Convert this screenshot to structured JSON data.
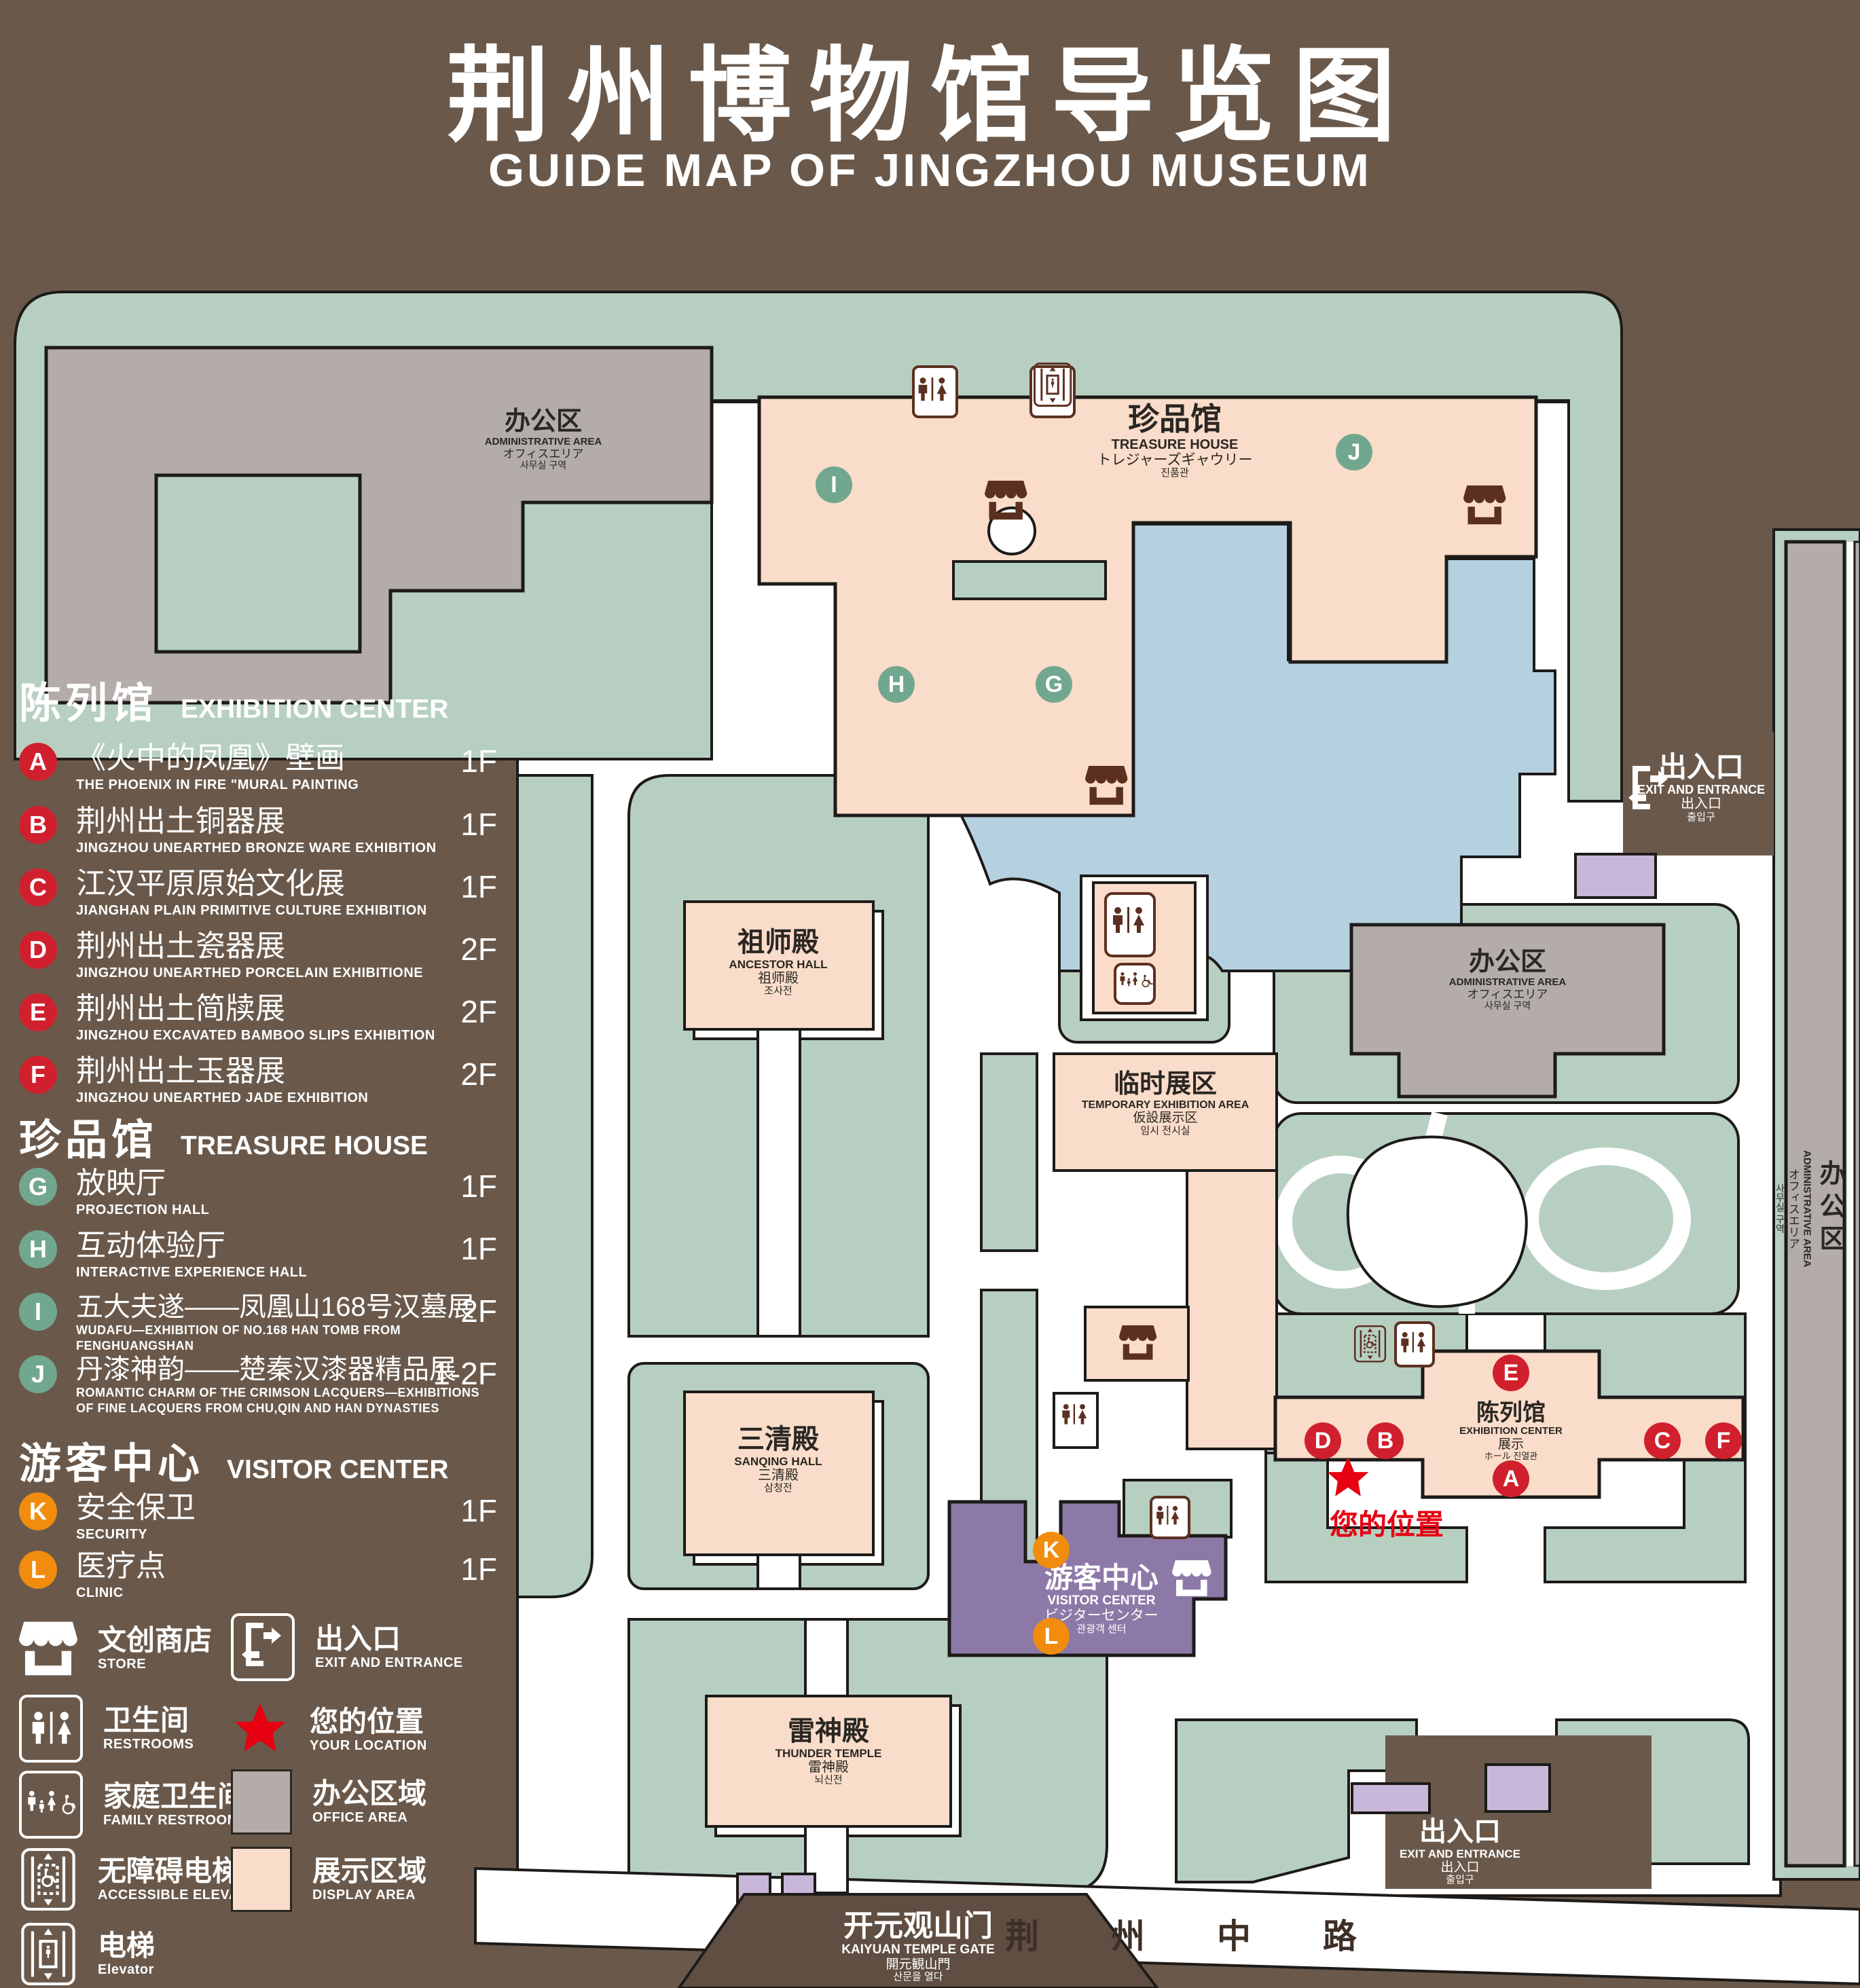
{
  "title": {
    "cn": "荆州博物馆导览图",
    "en": "GUIDE MAP OF JINGZHOU MUSEUM"
  },
  "legend": {
    "sections": [
      {
        "cn": "陈列馆",
        "en": "EXHIBITION CENTER",
        "items": [
          {
            "letter": "A",
            "cn": "《火中的凤凰》壁画",
            "en": "THE PHOENIX IN FIRE \"MURAL PAINTING",
            "floor": "1F"
          },
          {
            "letter": "B",
            "cn": "荆州出土铜器展",
            "en": "JINGZHOU UNEARTHED BRONZE WARE EXHIBITION",
            "floor": "1F"
          },
          {
            "letter": "C",
            "cn": "江汉平原原始文化展",
            "en": "JIANGHAN PLAIN PRIMITIVE CULTURE EXHIBITION",
            "floor": "1F"
          },
          {
            "letter": "D",
            "cn": "荆州出土瓷器展",
            "en": "JINGZHOU UNEARTHED PORCELAIN EXHIBITIONE",
            "floor": "2F"
          },
          {
            "letter": "E",
            "cn": "荆州出土简牍展",
            "en": "JINGZHOU EXCAVATED BAMBOO SLIPS EXHIBITION",
            "floor": "2F"
          },
          {
            "letter": "F",
            "cn": "荆州出土玉器展",
            "en": "JINGZHOU UNEARTHED JADE EXHIBITION",
            "floor": "2F"
          }
        ]
      },
      {
        "cn": "珍品馆",
        "en": "TREASURE HOUSE",
        "items": [
          {
            "letter": "G",
            "cn": "放映厅",
            "en": "PROJECTION HALL",
            "floor": "1F"
          },
          {
            "letter": "H",
            "cn": "互动体验厅",
            "en": "INTERACTIVE EXPERIENCE HALL",
            "floor": "1F"
          },
          {
            "letter": "I",
            "cn": "五大夫遂——凤凰山168号汉墓展",
            "en": "WUDAFU—EXHIBITION OF NO.168 HAN TOMB FROM FENGHUANGSHAN",
            "floor": "2F"
          },
          {
            "letter": "J",
            "cn": "丹漆神韵——楚秦汉漆器精品展",
            "en": "ROMANTIC CHARM OF THE CRIMSON LACQUERS—EXHIBITIONS",
            "en2": "OF FINE LACQUERS FROM CHU,QIN AND HAN DYNASTIES",
            "floor": "1-2F"
          }
        ]
      },
      {
        "cn": "游客中心",
        "en": "VISITOR CENTER",
        "items": [
          {
            "letter": "K",
            "cn": "安全保卫",
            "en": "SECURITY",
            "floor": "1F"
          },
          {
            "letter": "L",
            "cn": "医疗点",
            "en": "CLINIC",
            "floor": "1F"
          }
        ]
      }
    ],
    "symbols": {
      "store": {
        "cn": "文创商店",
        "en": "STORE"
      },
      "exit": {
        "cn": "出入口",
        "en": "EXIT AND ENTRANCE"
      },
      "restrooms": {
        "cn": "卫生间",
        "en": "RESTROOMS"
      },
      "location": {
        "cn": "您的位置",
        "en": "YOUR LOCATION"
      },
      "family": {
        "cn": "家庭卫生间",
        "en": "FAMILY RESTROOMS"
      },
      "office": {
        "cn": "办公区域",
        "en": "OFFICE AREA"
      },
      "accessible": {
        "cn": "无障碍电梯",
        "en": "ACCESSIBLE ELEVATOR"
      },
      "display": {
        "cn": "展示区域",
        "en": "DISPLAY AREA"
      },
      "elevator": {
        "cn": "电梯",
        "en": "Elevator"
      }
    }
  },
  "map": {
    "buildings": {
      "admin_nw": {
        "cn": "办公区",
        "en": "ADMINISTRATIVE AREA",
        "ja": "オフィスエリア",
        "ko": "사무실 구역"
      },
      "treasure": {
        "cn": "珍品馆",
        "en": "TREASURE HOUSE",
        "ja": "トレジャーズギャウリー",
        "ko": "진품관"
      },
      "ancestor": {
        "cn": "祖师殿",
        "en": "ANCESTOR HALL",
        "ja": "祖师殿",
        "ko": "조사전"
      },
      "sanqing": {
        "cn": "三清殿",
        "en": "SANQING HALL",
        "ja": "三清殿",
        "ko": "삼청전"
      },
      "temporary": {
        "cn": "临时展区",
        "en": "TEMPORARY EXHIBITION AREA",
        "ja": "仮設展示区",
        "ko": "임시 전시실"
      },
      "admin_e": {
        "cn": "办公区",
        "en": "ADMINISTRATIVE AREA",
        "ja": "オフィスエリア",
        "ko": "사무실 구역"
      },
      "admin_strip": {
        "cn": "办公区",
        "en": "ADMINISTRATIVE AREA",
        "ja": "オフィスエリア",
        "ko": "사무실 구역"
      },
      "exhibition": {
        "cn": "陈列馆",
        "en": "EXHIBITION CENTER",
        "ja": "展示",
        "ko": "ホール 진열관"
      },
      "visitor": {
        "cn": "游客中心",
        "en": "VISITOR CENTER",
        "ja": "ビジターセンター",
        "ko": "관광객 센터"
      },
      "thunder": {
        "cn": "雷神殿",
        "en": "THUNDER TEMPLE",
        "ja": "雷神殿",
        "ko": "뇌신전"
      },
      "gate": {
        "cn": "开元观山门",
        "en": "KAIYUAN TEMPLE GATE",
        "ja": "開元観山門",
        "ko": "산문을 열다"
      },
      "exit_e": {
        "cn": "出入口",
        "en": "EXIT AND ENTRANCE",
        "ja": "出入口",
        "ko": "출입구"
      },
      "exit_s": {
        "cn": "出入口",
        "en": "EXIT AND ENTRANCE",
        "ja": "出入口",
        "ko": "출입구"
      }
    },
    "road": "荆 州 中 路",
    "your_location": "您的位置",
    "markers": {
      "A": "A",
      "B": "B",
      "C": "C",
      "D": "D",
      "E": "E",
      "F": "F",
      "G": "G",
      "H": "H",
      "I": "I",
      "J": "J",
      "K": "K",
      "L": "L"
    }
  },
  "colors": {
    "background": "#6a594b",
    "park_green": "#b7cfc1",
    "display_area": "#f9dcc9",
    "office_area": "#b3aca8",
    "pond_blue": "#b5d1e0",
    "visitor_purple": "#8d79a7",
    "booth_purple": "#c9b7d9",
    "marker_red": "#d0202d",
    "marker_green": "#72a78f",
    "marker_orange": "#f18c0e",
    "icon_brown": "#5c3020",
    "star_red": "#e60012"
  }
}
